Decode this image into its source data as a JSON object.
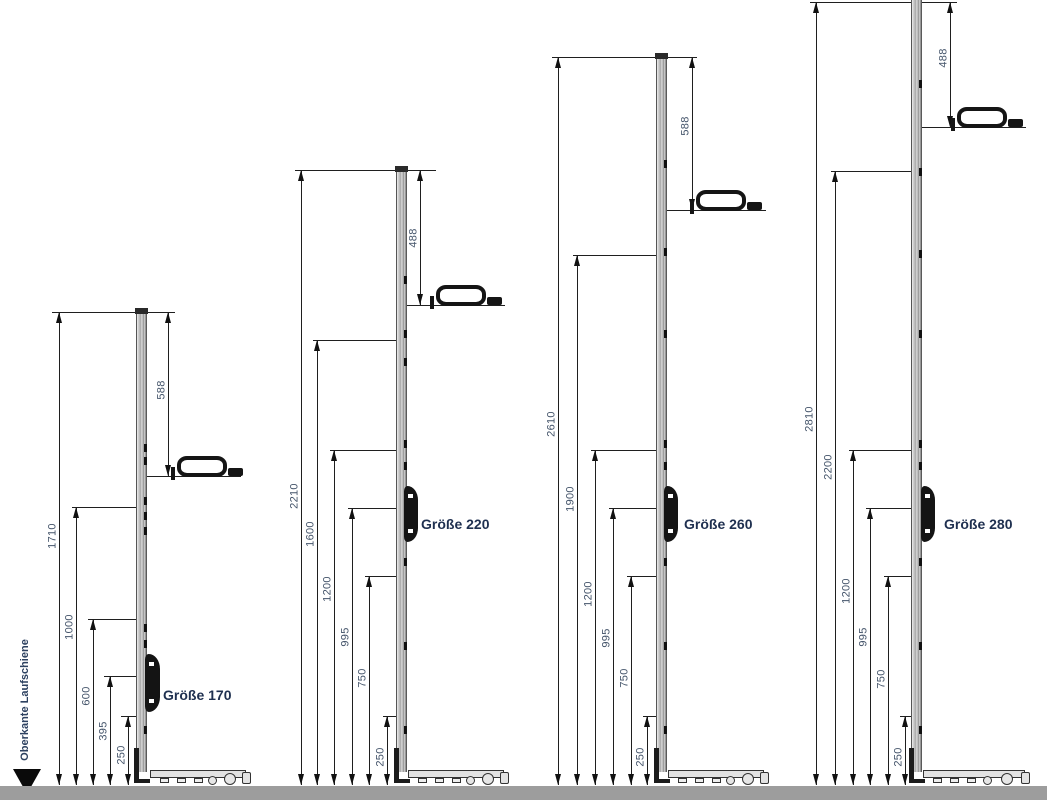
{
  "drawing": {
    "datum_label": "Oberkante Laufschiene",
    "groups": [
      {
        "name": "Größe 170",
        "handle_dim": "588",
        "dims": [
          "1710",
          "1000",
          "600",
          "395",
          "250"
        ]
      },
      {
        "name": "Größe 220",
        "handle_dim": "488",
        "dims": [
          "2210",
          "1600",
          "1200",
          "995",
          "750",
          "250"
        ]
      },
      {
        "name": "Größe 260",
        "handle_dim": "588",
        "dims": [
          "2610",
          "1900",
          "1200",
          "995",
          "750",
          "250"
        ]
      },
      {
        "name": "Größe 280",
        "handle_dim": "488",
        "dims": [
          "2810",
          "2200",
          "1200",
          "995",
          "750",
          "250"
        ]
      }
    ]
  }
}
